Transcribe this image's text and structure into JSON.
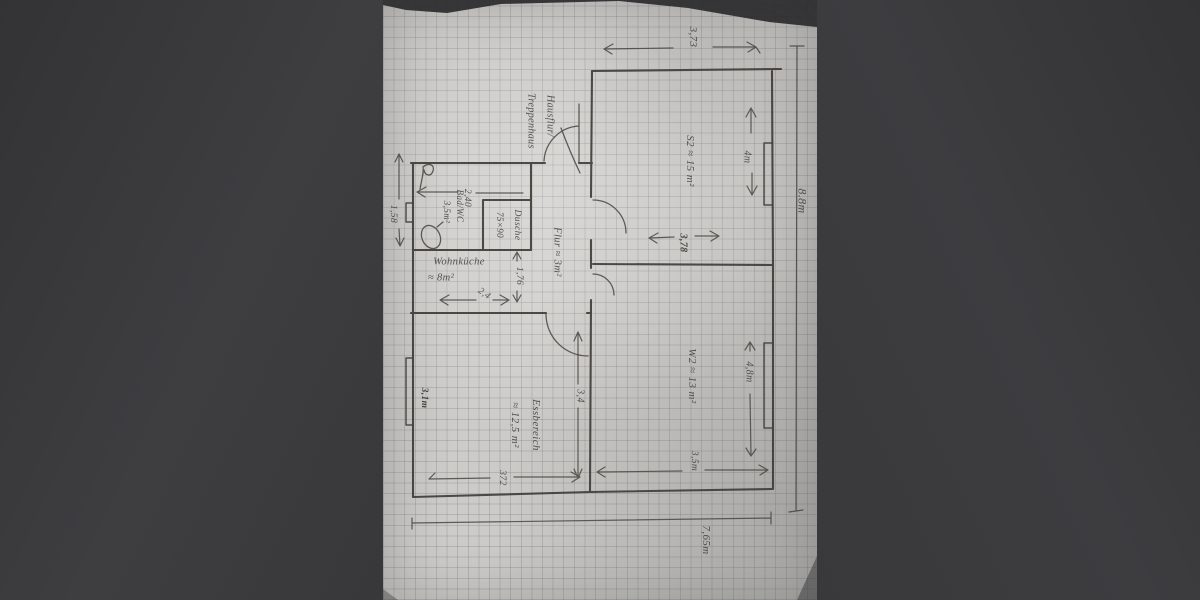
{
  "floorplan": {
    "rooms": {
      "s2": {
        "label": "S2 ≈ 15 m²"
      },
      "w2": {
        "label": "W2 ≈ 13 m²"
      },
      "essbereich": {
        "name": "Essbereich",
        "area": "≈ 12,5 m²"
      },
      "flur": {
        "label": "Flur ≈ 3m²"
      },
      "wohnkueche": {
        "name": "Wohnküche",
        "area": "≈ 8m²"
      },
      "bad": {
        "name": "Bad/WC",
        "area": "3,5m²"
      },
      "dusche": {
        "name": "Dusche",
        "size": "75×90"
      },
      "hausflur": {
        "line1": "Hausflur/",
        "line2": "Treppenhaus"
      }
    },
    "dimensions": {
      "top_width": "3,73",
      "right_height": "8.8m",
      "s2_window": "4m",
      "middle_width": "3,78",
      "w2_window": "4,8m",
      "w2_width": "3,5m",
      "ess_depth": "3,4",
      "ess_width": "372",
      "bottom_width": "7,65m",
      "bad_width": "2,40",
      "flur_width": "1,76",
      "kitchen_width": "2,4",
      "left_upper": "1,58",
      "left_window": "3,1m"
    },
    "colors": {
      "paper": "#cbc9c5",
      "pencil": "#45423d",
      "background": "#3a3a3c"
    }
  }
}
